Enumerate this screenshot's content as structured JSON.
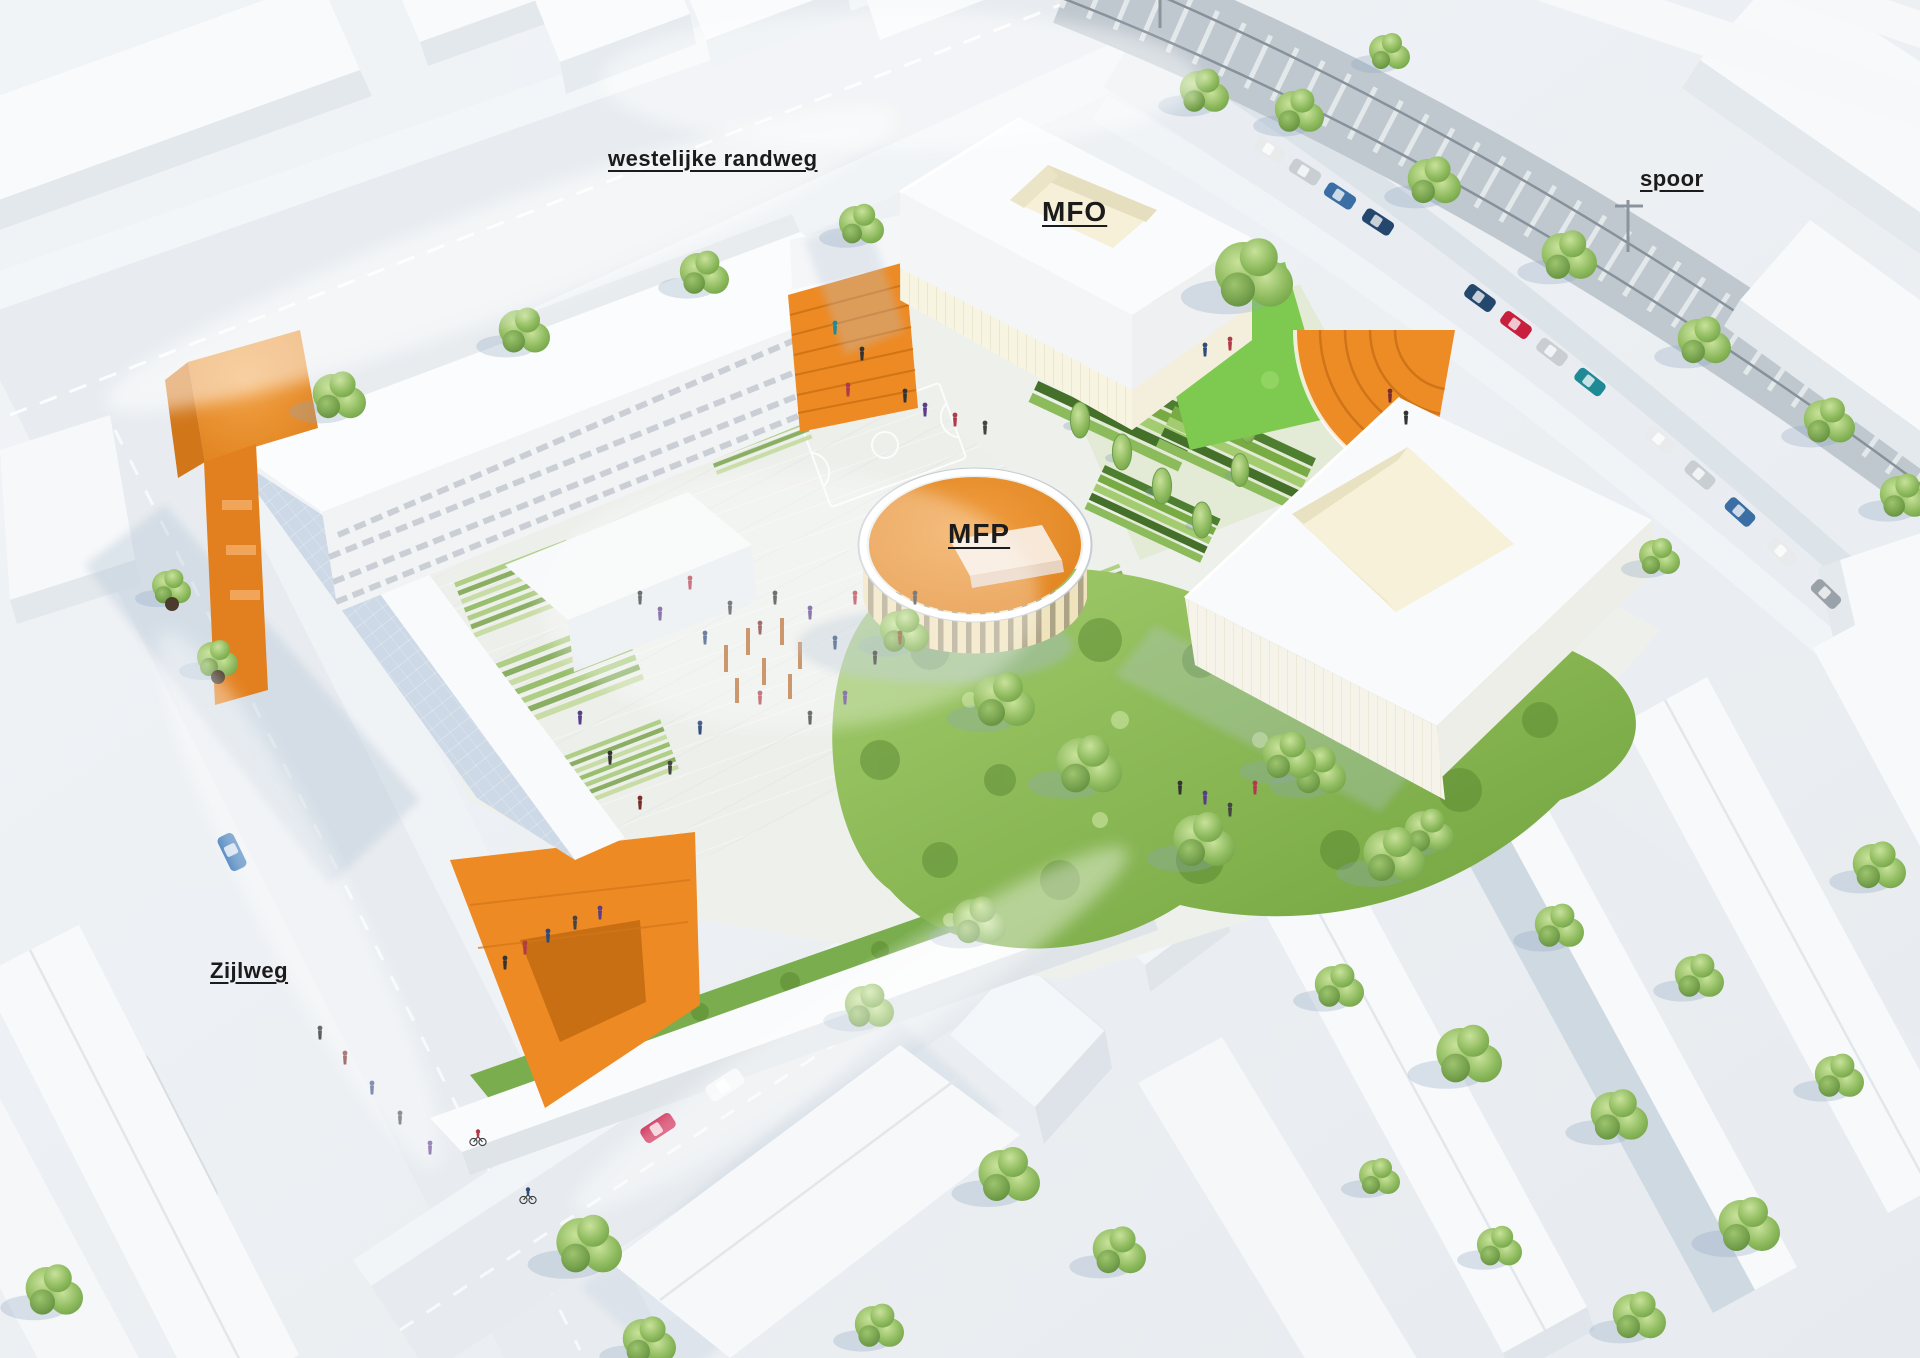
{
  "scene": {
    "description": "Aerial architectural rendering of a school campus site plan with labelled roads and buildings",
    "labels": {
      "road_top": "westelijke randweg",
      "building_mfo": "MFO",
      "railway": "spoor",
      "pavilion_mfp": "MFP",
      "road_left": "Zijlweg"
    },
    "colors": {
      "accent_orange": "#ED8A24",
      "roof_orange": "#E5892D",
      "step_orange": "#CF7418",
      "background": "#EDF0F4",
      "road": "#E8ECF0",
      "sidewalk": "#F2F5F8",
      "shadow_blue": "#B7C7D7",
      "building_white": "#FAFBFD",
      "facade_cream": "#F6F0D8",
      "lawn_green": "#7EC94F",
      "meadow_green": "#8CBB54",
      "tree_green_light": "#C1DD90",
      "tree_green_dark": "#5C8A38",
      "railway_gray": "#BFC8CF"
    }
  }
}
